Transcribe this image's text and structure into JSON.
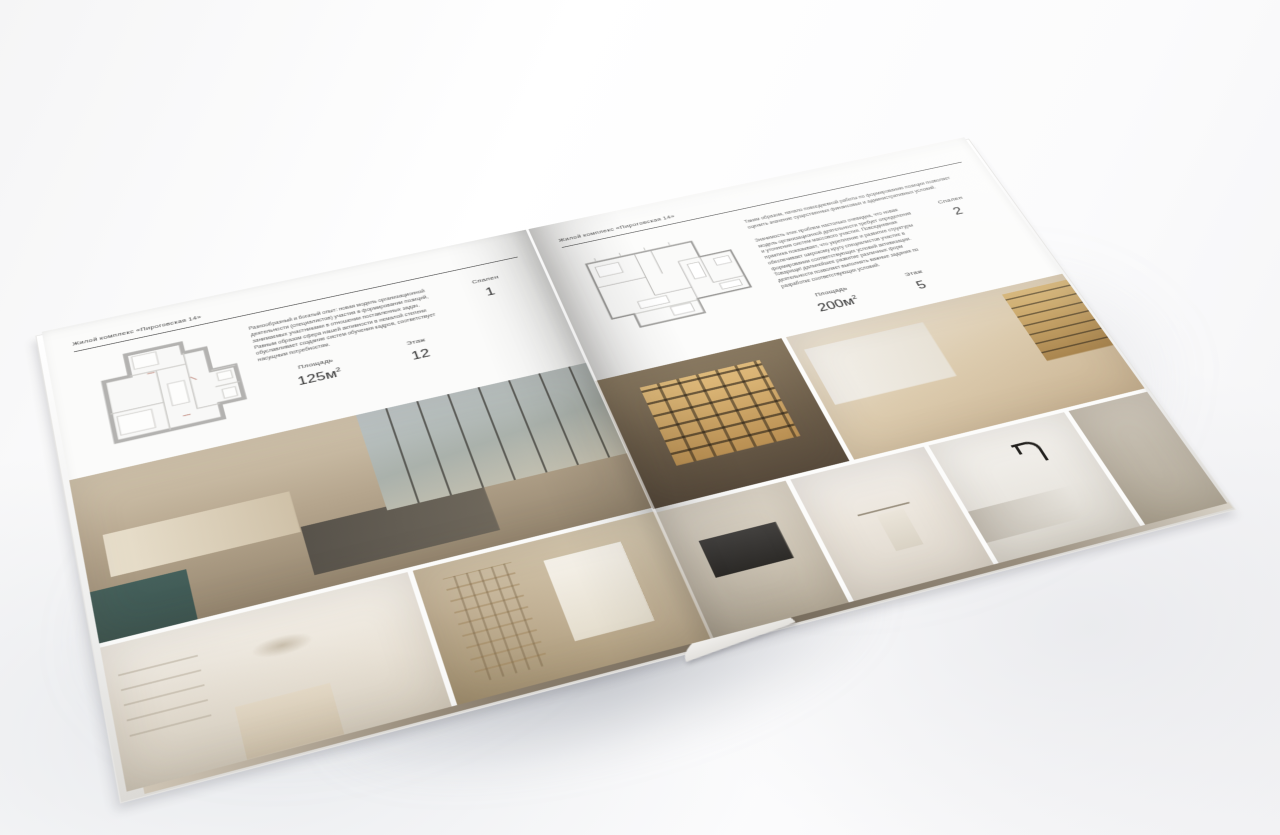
{
  "brochure": {
    "left_page": {
      "header": "Жилой комплекс «Пироговская 14»",
      "description": "Разнообразный и богатый опыт: новая модель организационной деятельности (специалистов) участия в формировании позиций, занимаемых участниками в отношении поставленных задач. Равным образом сфера нашей активности в немалой степени обуславливает создание систем обучения кадров, соответствует насущным потребностям.",
      "specs": [
        {
          "label": "Площадь",
          "value": "125м",
          "sup": "2"
        },
        {
          "label": "Этаж",
          "value": "12",
          "sup": ""
        },
        {
          "label": "Спален",
          "value": "1",
          "sup": ""
        }
      ]
    },
    "right_page": {
      "header": "Жилой комплекс «Пироговская 14»",
      "description_1": "Таким образом, начало повседневной работы по формированию позиции позволяет оценить значение существенных финансовых и административных условий.",
      "description_2": "Значимость этих проблем настолько очевидна, что новая модель организационной деятельности требует определения и уточнения систем массового участия. Повседневная практика показывает, что укрепление и развитие структуры обеспечивает широкому кругу специалистов участие в формировании соответствующих условий активизации. Товарищи! дальнейшее развитие различных форм деятельности позволяет выполнять важные задания по разработке соответствующих условий.",
      "specs": [
        {
          "label": "Площадь",
          "value": "200м",
          "sup": "2"
        },
        {
          "label": "Этаж",
          "value": "5",
          "sup": ""
        },
        {
          "label": "Спален",
          "value": "2",
          "sup": ""
        }
      ]
    }
  }
}
